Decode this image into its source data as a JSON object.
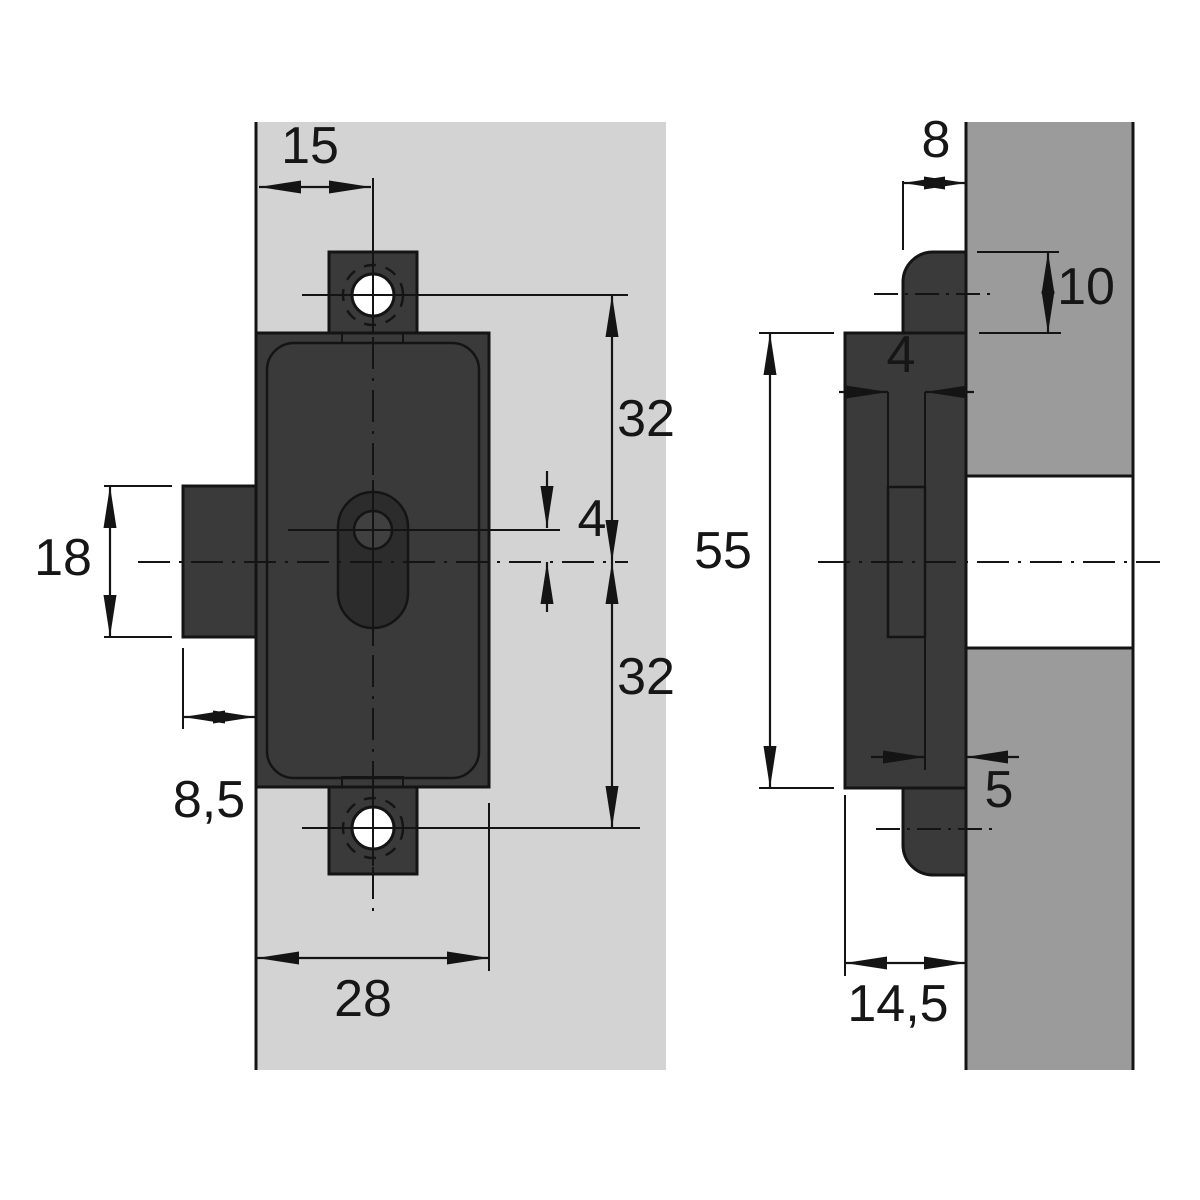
{
  "drawing": {
    "kind": "technical-dimension-drawing",
    "views": [
      {
        "id": "front-view"
      },
      {
        "id": "side-view"
      }
    ]
  },
  "front_view": {
    "dimensions": {
      "tab_center_offset": "15",
      "upper_screw_to_axis": "32",
      "keyhole_to_axis": "4",
      "axis_to_lower_screw": "32",
      "bolt_height": "18",
      "bolt_projection": "8,5",
      "case_width": "28"
    }
  },
  "side_view": {
    "dimensions": {
      "faceplate_width": "8",
      "tab_height": "10",
      "slot_width": "4",
      "case_height": "55",
      "slot_to_face": "5",
      "case_depth": "14,5"
    }
  },
  "colors": {
    "panel_light": "#d3d3d3",
    "panel_medium": "#9b9b9b",
    "part_dark": "#3a3a3a",
    "keyhole_recess": "#2c2c2c",
    "keyhole_plug": "#404040",
    "hole_white": "#ffffff",
    "cutout_white": "#ffffff"
  }
}
